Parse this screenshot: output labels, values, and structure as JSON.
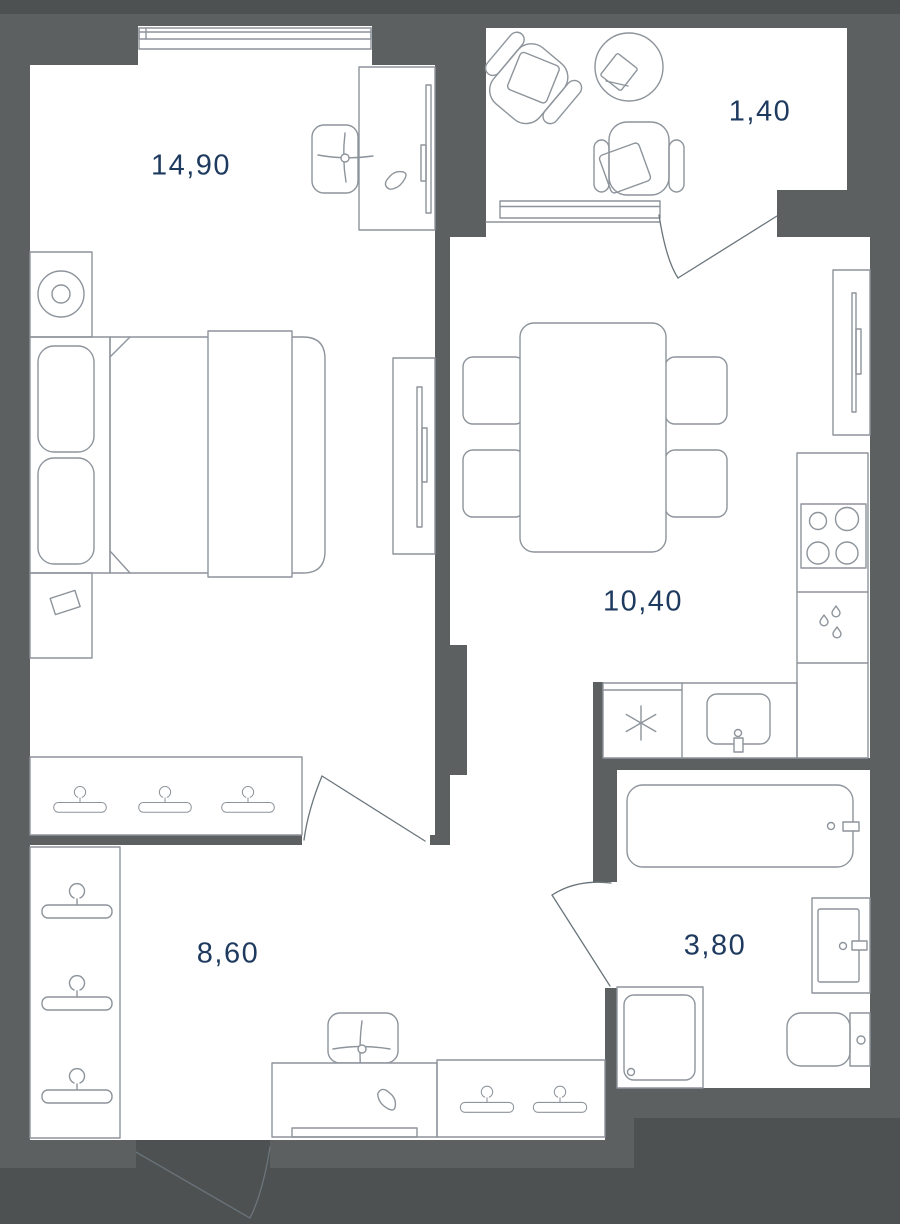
{
  "floorplan": {
    "type_label": "one-bedroom apartment floor plan",
    "rooms": [
      {
        "id": "bedroom",
        "area": "14,90"
      },
      {
        "id": "balcony",
        "area": "1,40"
      },
      {
        "id": "kitchen-living",
        "area": "10,40"
      },
      {
        "id": "hallway",
        "area": "8,60"
      },
      {
        "id": "bathroom",
        "area": "3,80"
      }
    ],
    "icons": [
      "window-icon",
      "door-swing-icon",
      "bed-icon",
      "pillow-icon",
      "wardrobe-hanger-icon",
      "office-chair-icon",
      "desk-icon",
      "computer-mouse-icon",
      "tv-icon",
      "floor-lamp-icon",
      "dining-table-icon",
      "chair-icon",
      "stove-burners-icon",
      "fridge-snowflake-icon",
      "sink-icon",
      "water-drops-icon",
      "bathtub-icon",
      "vanity-sink-icon",
      "toilet-icon",
      "washing-machine-icon",
      "armchair-icon",
      "coffee-table-icon"
    ],
    "colors": {
      "outside": "#4e5152",
      "wall": "#5c6061",
      "room": "#ffffff",
      "line": "#8d949b",
      "door_line": "#6a757b",
      "label": "#1e3a5f"
    }
  }
}
